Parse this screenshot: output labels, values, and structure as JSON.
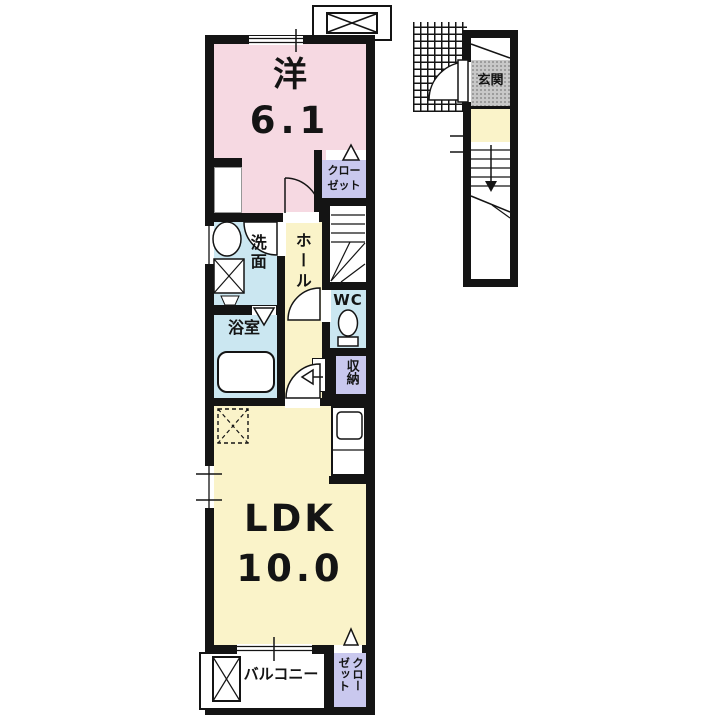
{
  "rooms": {
    "western": {
      "name": "洋",
      "area": "6.1"
    },
    "bedroom_closet": {
      "label": "クローゼット"
    },
    "washroom": {
      "label": "洗面"
    },
    "hall": {
      "label": "ホール"
    },
    "wc": {
      "label": "WC"
    },
    "bath": {
      "label": "浴室"
    },
    "storage": {
      "label": "収納"
    },
    "ldk": {
      "name": "LDK",
      "area": "10.0"
    },
    "balcony": {
      "label": "バルコニー"
    },
    "ldk_closet": {
      "label": "クローゼット"
    },
    "entrance": {
      "label": "玄関"
    }
  },
  "colors": {
    "wall": "#141414",
    "western_room": "#F6D9E2",
    "living": "#FAF3C9",
    "wet_area": "#CBE7F1",
    "closet": "#C9C8EE",
    "entrance": "#C8C8C8",
    "background": "#FFFFFF"
  }
}
